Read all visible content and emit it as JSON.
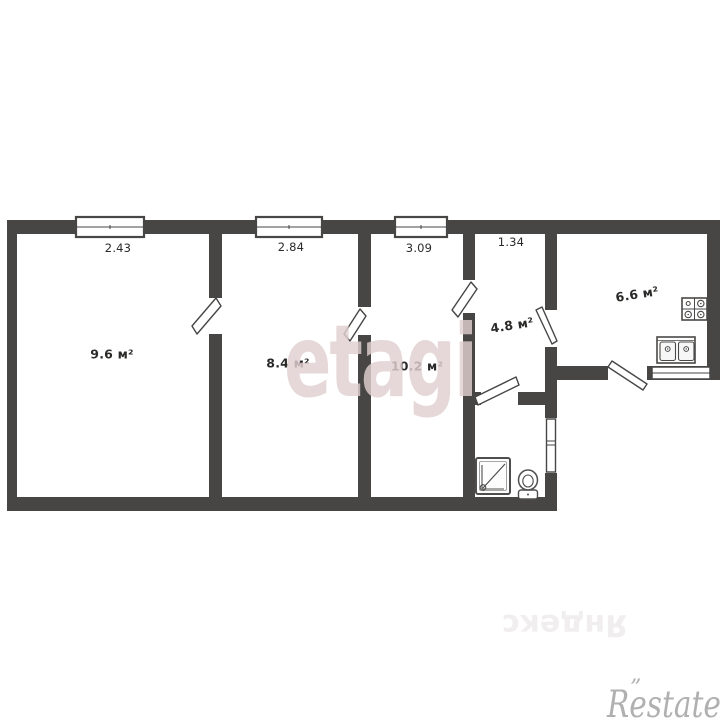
{
  "plan": {
    "rooms": [
      {
        "name": "room-1",
        "area": "9.6 м²"
      },
      {
        "name": "room-2",
        "area": "8.4 м²"
      },
      {
        "name": "room-3",
        "area": "10.2 м²"
      },
      {
        "name": "hallway",
        "area": "4.8 м²"
      },
      {
        "name": "kitchen",
        "area": "6.6 м²"
      }
    ],
    "dimensions_m": [
      "2.43",
      "2.84",
      "3.09",
      "1.34"
    ]
  },
  "watermarks": {
    "center": "etagi",
    "bottom_center": "Яндекс",
    "bottom_right": "Restate",
    "bottom_right_mark": "”"
  },
  "colors": {
    "wall": "#474645",
    "background": "#ffffff",
    "center_watermark": "#e0cfcf",
    "bottom_right_watermark": "#969696"
  }
}
